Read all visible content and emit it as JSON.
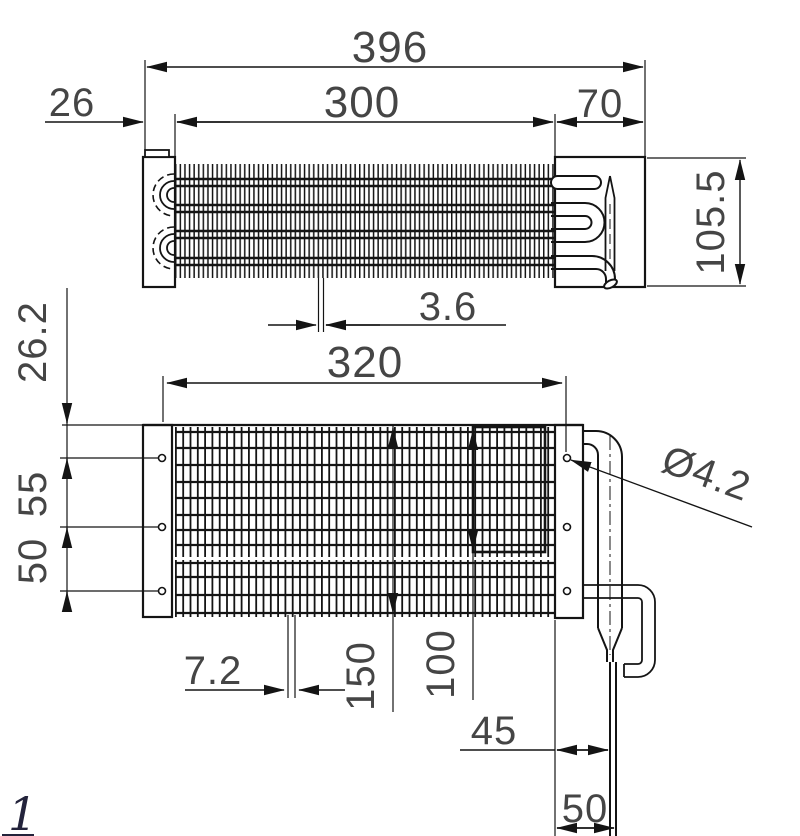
{
  "drawing": {
    "figure_label": "1",
    "colors": {
      "line": "#141414",
      "dim_text": "#454545"
    },
    "top_view": {
      "dim_overall_length": "396",
      "dim_fin_length": "300",
      "dim_header_length": "70",
      "dim_left_offset": "26",
      "dim_height": "105.5",
      "dim_fin_pitch": "3.6"
    },
    "bottom_view": {
      "dim_fin_length": "320",
      "dim_hole_offset_top": "26.2",
      "dim_hole_spacing_upper": "55",
      "dim_hole_spacing_lower": "50",
      "dim_hole_diameter": "Ø4.2",
      "dim_coil_height": "150",
      "dim_section_height": "100",
      "dim_fin_pitch": "7.2",
      "dim_tube_offset_inner": "45",
      "dim_tube_offset_outer": "50"
    }
  }
}
